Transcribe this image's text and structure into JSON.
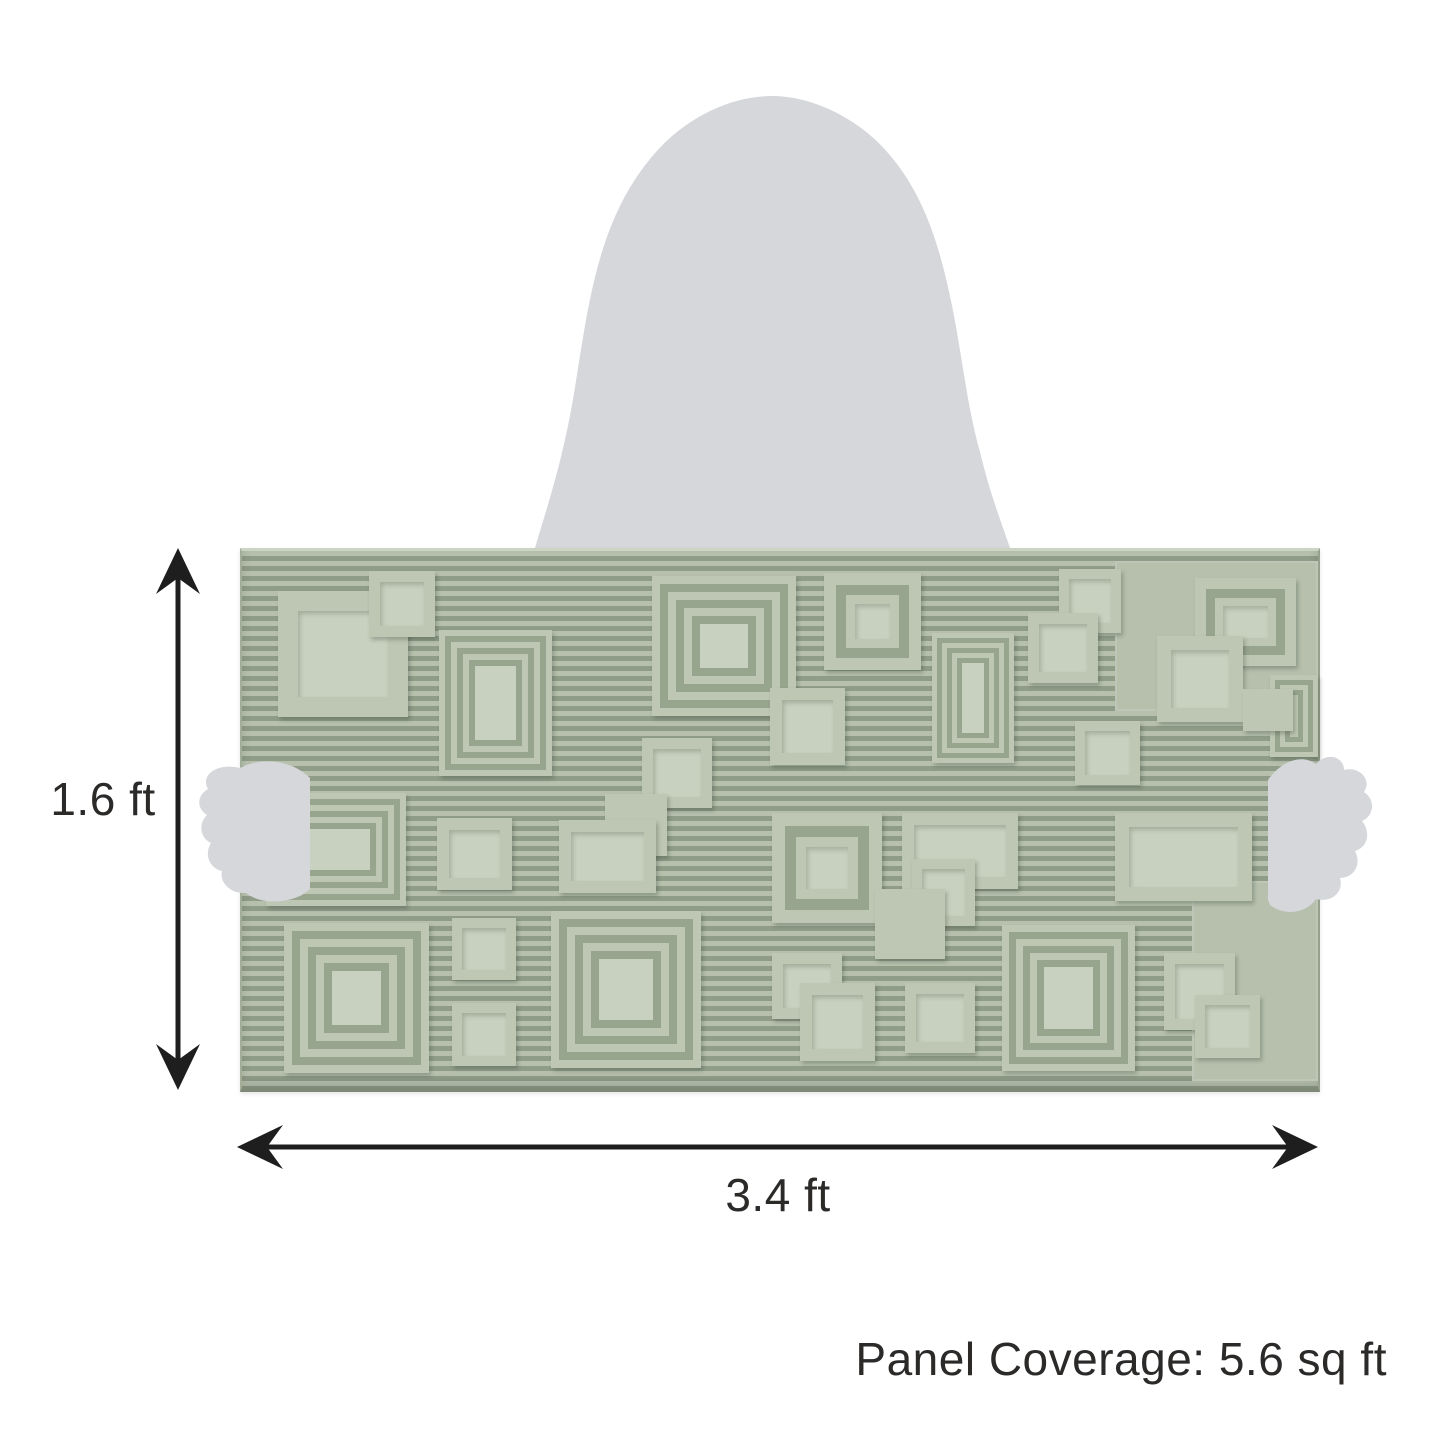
{
  "labels": {
    "height": "1.6 ft",
    "width": "3.4 ft",
    "coverage": "Panel Coverage: 5.6 sq ft"
  },
  "colors": {
    "panel_light": "#b6c0ad",
    "panel_dark": "#8f9c88",
    "frame_light": "#bdc7b3",
    "recess": "#c8d1bf",
    "gap_dark": "#97a48e",
    "silhouette": "#d5d7da",
    "arrow": "#1e1e1e",
    "text": "#2b2a29",
    "background": "#ffffff"
  },
  "panel": {
    "x": 240,
    "y": 548,
    "width": 1076,
    "height": 537,
    "squares": [
      {
        "t": "plate",
        "x": 873,
        "y": 10,
        "w": 203,
        "h": 150
      },
      {
        "t": "plate",
        "x": 950,
        "y": 330,
        "w": 126,
        "h": 200
      },
      {
        "t": "frame",
        "x": 36,
        "y": 40,
        "w": 130,
        "h": 126
      },
      {
        "t": "frame",
        "x": 127,
        "y": 20,
        "w": 66,
        "h": 66
      },
      {
        "t": "conc",
        "x": 197,
        "y": 79,
        "w": 113,
        "h": 146
      },
      {
        "t": "conc",
        "x": 410,
        "y": 25,
        "w": 144,
        "h": 140
      },
      {
        "t": "double",
        "x": 582,
        "y": 22,
        "w": 97,
        "h": 97
      },
      {
        "t": "frame",
        "x": 817,
        "y": 18,
        "w": 62,
        "h": 64
      },
      {
        "t": "frame",
        "x": 786,
        "y": 62,
        "w": 70,
        "h": 70
      },
      {
        "t": "double",
        "x": 953,
        "y": 27,
        "w": 101,
        "h": 88
      },
      {
        "t": "frame",
        "x": 915,
        "y": 85,
        "w": 86,
        "h": 86
      },
      {
        "t": "conc",
        "x": 1028,
        "y": 124,
        "w": 48,
        "h": 82
      },
      {
        "t": "frame",
        "x": 833,
        "y": 170,
        "w": 65,
        "h": 64
      },
      {
        "t": "solid",
        "x": 1001,
        "y": 138,
        "w": 50,
        "h": 42
      },
      {
        "t": "conc",
        "x": 690,
        "y": 82,
        "w": 82,
        "h": 130
      },
      {
        "t": "conc",
        "x": 24,
        "y": 242,
        "w": 140,
        "h": 113
      },
      {
        "t": "frame",
        "x": 195,
        "y": 267,
        "w": 75,
        "h": 72
      },
      {
        "t": "frame",
        "x": 400,
        "y": 187,
        "w": 70,
        "h": 70
      },
      {
        "t": "solid",
        "x": 363,
        "y": 243,
        "w": 62,
        "h": 62
      },
      {
        "t": "frame",
        "x": 528,
        "y": 137,
        "w": 75,
        "h": 77
      },
      {
        "t": "frame",
        "x": 317,
        "y": 269,
        "w": 97,
        "h": 73
      },
      {
        "t": "double",
        "x": 530,
        "y": 262,
        "w": 110,
        "h": 110
      },
      {
        "t": "frame",
        "x": 660,
        "y": 262,
        "w": 116,
        "h": 76
      },
      {
        "t": "frame",
        "x": 670,
        "y": 308,
        "w": 63,
        "h": 67
      },
      {
        "t": "solid",
        "x": 633,
        "y": 338,
        "w": 70,
        "h": 70
      },
      {
        "t": "frame",
        "x": 873,
        "y": 262,
        "w": 137,
        "h": 88
      },
      {
        "t": "conc",
        "x": 42,
        "y": 372,
        "w": 145,
        "h": 150
      },
      {
        "t": "frame",
        "x": 210,
        "y": 367,
        "w": 64,
        "h": 62
      },
      {
        "t": "frame",
        "x": 210,
        "y": 452,
        "w": 64,
        "h": 63
      },
      {
        "t": "conc",
        "x": 309,
        "y": 360,
        "w": 150,
        "h": 157
      },
      {
        "t": "frame",
        "x": 530,
        "y": 402,
        "w": 70,
        "h": 66
      },
      {
        "t": "frame",
        "x": 558,
        "y": 432,
        "w": 75,
        "h": 78
      },
      {
        "t": "frame",
        "x": 663,
        "y": 432,
        "w": 70,
        "h": 70
      },
      {
        "t": "conc",
        "x": 760,
        "y": 374,
        "w": 133,
        "h": 146
      },
      {
        "t": "frame",
        "x": 922,
        "y": 402,
        "w": 71,
        "h": 77
      },
      {
        "t": "frame",
        "x": 953,
        "y": 444,
        "w": 65,
        "h": 63
      }
    ]
  },
  "figure": {
    "description": "woman-silhouette-holding-panel"
  },
  "arrows": {
    "vertical": {
      "x": 178,
      "y1": 548,
      "y2": 1090
    },
    "horizontal": {
      "y": 1147,
      "x1": 237,
      "x2": 1318
    }
  }
}
